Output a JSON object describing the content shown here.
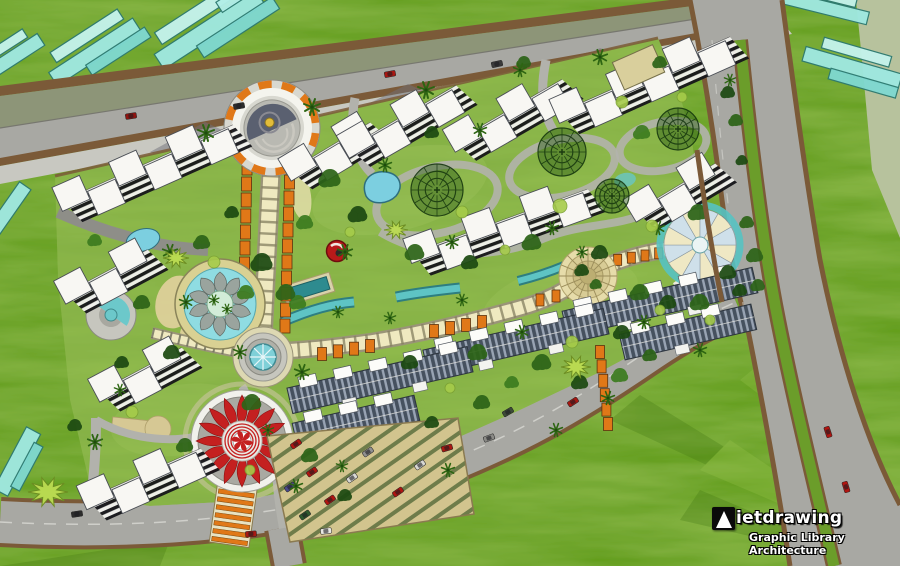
{
  "watermark": {
    "brand": "Vietdrawing",
    "brand_text_after_logo": "ietdrawing",
    "subtitle": "Graphic Library Architecture"
  },
  "palette": {
    "grass": "#639e1c",
    "site_lawn": "#84b044",
    "sage": "#b7c29d",
    "road_gray": "#a8a8a3",
    "road_olive": "#8d9578",
    "road_edge_brown": "#7b5a38",
    "sidewalk": "#c8c8c1",
    "water_cyan": "#8fdce2",
    "water_teal": "#5ec4c4",
    "glass_teal": "#9fe8e0",
    "building_white": "#f8f7f3",
    "roof_slate": "#46515f",
    "pergola_orange": "#e07818",
    "walkway_cream": "#efe9c0",
    "plaza_tan": "#e6dcaa",
    "flame_red": "#c42020",
    "sand": "#d2c48e",
    "tree_dark": "#1d4a12",
    "hedge_light": "#bcdc52"
  },
  "scene": {
    "glass_clusters": [
      {
        "x": 210,
        "y": 30,
        "ang": -33,
        "bars": [
          [
            -60,
            -10,
            120,
            18,
            "#9fe8e0"
          ],
          [
            -48,
            -28,
            100,
            14,
            "#c4f2ec"
          ],
          [
            -20,
            6,
            90,
            14,
            "#7fd8d0"
          ],
          [
            20,
            -20,
            60,
            12,
            "#b2eee8"
          ]
        ]
      },
      {
        "x": 95,
        "y": 52,
        "ang": -33,
        "bars": [
          [
            -50,
            -8,
            100,
            16,
            "#9fe8e0"
          ],
          [
            -38,
            -24,
            80,
            12,
            "#c4f2ec"
          ],
          [
            -15,
            6,
            70,
            12,
            "#7fd8d0"
          ]
        ]
      },
      {
        "x": 8,
        "y": 62,
        "ang": -33,
        "bars": [
          [
            -40,
            -8,
            80,
            14,
            "#9fe8e0"
          ],
          [
            -30,
            -20,
            60,
            10,
            "#c4f2ec"
          ]
        ]
      },
      {
        "x": 6,
        "y": 215,
        "ang": -55,
        "bars": [
          [
            -35,
            -8,
            70,
            14,
            "#9fe8e0"
          ]
        ]
      },
      {
        "x": 18,
        "y": 462,
        "ang": -62,
        "bars": [
          [
            -35,
            -9,
            70,
            16,
            "#9fe8e0"
          ],
          [
            -25,
            5,
            50,
            10,
            "#7fd8d0"
          ]
        ]
      },
      {
        "x": 824,
        "y": 8,
        "ang": 14,
        "bars": [
          [
            -45,
            -7,
            90,
            13,
            "#9fe8e0"
          ],
          [
            -30,
            -18,
            60,
            10,
            "#c4f2ec"
          ]
        ]
      },
      {
        "x": 852,
        "y": 68,
        "ang": 16,
        "bars": [
          [
            -50,
            -8,
            100,
            15,
            "#9fe8e0"
          ],
          [
            -35,
            -22,
            70,
            11,
            "#c4f2ec"
          ],
          [
            -20,
            6,
            70,
            11,
            "#7fd8d0"
          ]
        ]
      }
    ],
    "white_clusters": [
      {
        "x": 145,
        "y": 168,
        "ang": -24,
        "n": 6
      },
      {
        "x": 328,
        "y": 152,
        "ang": -31,
        "n": 3
      },
      {
        "x": 400,
        "y": 122,
        "ang": -30,
        "n": 4
      },
      {
        "x": 506,
        "y": 116,
        "ang": -30,
        "n": 4
      },
      {
        "x": 642,
        "y": 80,
        "ang": -24,
        "n": 6,
        "tan": true
      },
      {
        "x": 497,
        "y": 226,
        "ang": -20,
        "n": 6
      },
      {
        "x": 104,
        "y": 277,
        "ang": -28,
        "n": 3
      },
      {
        "x": 138,
        "y": 375,
        "ang": -28,
        "n": 3
      },
      {
        "x": 141,
        "y": 479,
        "ang": -24,
        "n": 4
      },
      {
        "x": 673,
        "y": 193,
        "ang": -31,
        "n": 3
      }
    ],
    "townhouse_rows": [
      {
        "x": 660,
        "y": 302,
        "len": 195,
        "ang": -13
      },
      {
        "x": 688,
        "y": 332,
        "len": 135,
        "ang": -13
      },
      {
        "x": 516,
        "y": 342,
        "len": 185,
        "ang": -13
      },
      {
        "x": 380,
        "y": 380,
        "len": 185,
        "ang": -13
      },
      {
        "x": 356,
        "y": 422,
        "len": 125,
        "ang": -13
      }
    ],
    "pergola_strips": [
      {
        "x1": 247,
        "y1": 168,
        "x2": 243,
        "y2": 328,
        "n": 11,
        "w": 10,
        "h": 14
      },
      {
        "x1": 290,
        "y1": 166,
        "x2": 285,
        "y2": 326,
        "n": 11,
        "w": 10,
        "h": 14
      },
      {
        "x1": 322,
        "y1": 354,
        "x2": 370,
        "y2": 346,
        "n": 4,
        "w": 9,
        "h": 13
      },
      {
        "x1": 434,
        "y1": 331,
        "x2": 482,
        "y2": 322,
        "n": 4,
        "w": 9,
        "h": 13
      },
      {
        "x1": 600,
        "y1": 352,
        "x2": 608,
        "y2": 424,
        "n": 6,
        "w": 9,
        "h": 13
      },
      {
        "x1": 604,
        "y1": 262,
        "x2": 686,
        "y2": 249,
        "n": 7,
        "w": 8,
        "h": 11
      },
      {
        "x1": 540,
        "y1": 300,
        "x2": 572,
        "y2": 292,
        "n": 3,
        "w": 8,
        "h": 12
      }
    ],
    "tree_rings": [
      [
        437,
        190,
        26
      ],
      [
        562,
        152,
        24
      ],
      [
        678,
        129,
        21
      ],
      [
        612,
        196,
        17
      ]
    ],
    "trees": [
      [
        330,
        178,
        9,
        1
      ],
      [
        358,
        214,
        8,
        0
      ],
      [
        305,
        222,
        7,
        2
      ],
      [
        415,
        252,
        8,
        1
      ],
      [
        470,
        262,
        7,
        0
      ],
      [
        532,
        242,
        8,
        1
      ],
      [
        600,
        252,
        7,
        0
      ],
      [
        640,
        292,
        8,
        1
      ],
      [
        668,
        302,
        7,
        0
      ],
      [
        700,
        302,
        8,
        1
      ],
      [
        622,
        332,
        7,
        0
      ],
      [
        478,
        352,
        8,
        1
      ],
      [
        410,
        362,
        7,
        0
      ],
      [
        252,
        402,
        8,
        1
      ],
      [
        172,
        352,
        7,
        0
      ],
      [
        142,
        302,
        7,
        1
      ],
      [
        122,
        362,
        6,
        0
      ],
      [
        202,
        242,
        7,
        1
      ],
      [
        232,
        212,
        6,
        0
      ],
      [
        542,
        362,
        8,
        1
      ],
      [
        580,
        382,
        7,
        0
      ],
      [
        298,
        302,
        7,
        2
      ],
      [
        698,
        212,
        8,
        1
      ],
      [
        728,
        272,
        7,
        0
      ],
      [
        642,
        132,
        7,
        2
      ],
      [
        524,
        62,
        6,
        1
      ],
      [
        432,
        132,
        6,
        0
      ],
      [
        482,
        402,
        7,
        1
      ],
      [
        432,
        422,
        6,
        0
      ],
      [
        512,
        382,
        6,
        2
      ],
      [
        660,
        62,
        6,
        1
      ],
      [
        728,
        92,
        6,
        0
      ],
      [
        755,
        255,
        7,
        1
      ],
      [
        740,
        290,
        6,
        0
      ],
      [
        95,
        240,
        6,
        2
      ],
      [
        185,
        445,
        7,
        1
      ],
      [
        75,
        425,
        6,
        0
      ],
      [
        310,
        455,
        7,
        1
      ],
      [
        345,
        495,
        6,
        0
      ],
      [
        620,
        375,
        7,
        2
      ],
      [
        650,
        355,
        6,
        1
      ],
      [
        262,
        262,
        9,
        0
      ],
      [
        286,
        292,
        8,
        1
      ],
      [
        246,
        292,
        7,
        2
      ],
      [
        736,
        120,
        6,
        1
      ],
      [
        742,
        160,
        5,
        0
      ],
      [
        747,
        222,
        6,
        1
      ],
      [
        758,
        285,
        6,
        1
      ],
      [
        582,
        270,
        6,
        0
      ],
      [
        596,
        284,
        5,
        1
      ]
    ],
    "palms": [
      [
        206,
        133,
        1
      ],
      [
        312,
        107,
        1
      ],
      [
        426,
        90,
        1
      ],
      [
        600,
        57,
        0.9
      ],
      [
        520,
        70,
        0.8
      ],
      [
        170,
        252,
        0.9
      ],
      [
        345,
        252,
        0.9
      ],
      [
        452,
        242,
        0.8
      ],
      [
        302,
        372,
        0.9
      ],
      [
        522,
        332,
        0.8
      ],
      [
        644,
        322,
        0.8
      ],
      [
        95,
        442,
        0.9
      ],
      [
        480,
        130,
        0.8
      ],
      [
        552,
        228,
        0.8
      ],
      [
        385,
        165,
        0.8
      ],
      [
        240,
        352,
        0.8
      ],
      [
        268,
        430,
        0.7
      ],
      [
        700,
        350,
        0.8
      ],
      [
        448,
        470,
        0.8
      ],
      [
        556,
        430,
        0.8
      ],
      [
        608,
        398,
        0.8
      ],
      [
        658,
        228,
        0.8
      ],
      [
        186,
        302,
        0.8
      ],
      [
        120,
        390,
        0.7
      ],
      [
        338,
        312,
        0.7
      ],
      [
        390,
        318,
        0.7
      ],
      [
        462,
        300,
        0.7
      ],
      [
        582,
        252,
        0.7
      ],
      [
        296,
        486,
        0.8
      ],
      [
        342,
        466,
        0.7
      ],
      [
        730,
        80,
        0.7
      ],
      [
        214,
        300,
        0.62
      ],
      [
        227,
        309,
        0.6
      ]
    ],
    "bushes": [
      [
        214,
        262,
        6
      ],
      [
        560,
        206,
        7
      ],
      [
        462,
        212,
        6
      ],
      [
        652,
        226,
        6
      ],
      [
        132,
        412,
        6
      ],
      [
        622,
        102,
        6
      ],
      [
        682,
        97,
        5
      ],
      [
        350,
        232,
        5
      ],
      [
        505,
        250,
        5
      ],
      [
        572,
        342,
        6
      ],
      [
        450,
        388,
        5
      ],
      [
        250,
        470,
        5
      ],
      [
        660,
        310,
        5
      ],
      [
        710,
        320,
        5
      ]
    ],
    "hedges": [
      [
        48,
        492,
        20
      ],
      [
        576,
        367,
        15
      ],
      [
        176,
        258,
        13
      ],
      [
        396,
        230,
        12
      ]
    ],
    "road_cars": [
      {
        "x": 131,
        "y": 116,
        "a": -9,
        "c": "#8e1410"
      },
      {
        "x": 239,
        "y": 106,
        "a": -10,
        "c": "#2c2c2c"
      },
      {
        "x": 390,
        "y": 74,
        "a": -11,
        "c": "#a81812"
      },
      {
        "x": 497,
        "y": 64,
        "a": -12,
        "c": "#3a3a3a"
      },
      {
        "x": 447,
        "y": 448,
        "a": -17,
        "c": "#a81812"
      },
      {
        "x": 489,
        "y": 438,
        "a": -20,
        "c": "#8a8a86"
      },
      {
        "x": 508,
        "y": 412,
        "a": -31,
        "c": "#3d4a38"
      },
      {
        "x": 573,
        "y": 402,
        "a": -33,
        "c": "#a81812"
      },
      {
        "x": 251,
        "y": 534,
        "a": -4,
        "c": "#a81812"
      },
      {
        "x": 326,
        "y": 531,
        "a": -7,
        "c": "#e8e8e4"
      },
      {
        "x": 77,
        "y": 514,
        "a": -8,
        "c": "#2c2c2c"
      },
      {
        "x": 828,
        "y": 432,
        "a": 72,
        "c": "#b01510"
      },
      {
        "x": 846,
        "y": 487,
        "a": 73,
        "c": "#b01510"
      }
    ],
    "parking_cars": [
      {
        "x": 296,
        "y": 444,
        "a": -35,
        "c": "#b01510"
      },
      {
        "x": 312,
        "y": 472,
        "a": -35,
        "c": "#b01510"
      },
      {
        "x": 330,
        "y": 500,
        "a": -35,
        "c": "#b01510"
      },
      {
        "x": 352,
        "y": 478,
        "a": -35,
        "c": "#d8d8d4"
      },
      {
        "x": 368,
        "y": 452,
        "a": -35,
        "c": "#909090"
      },
      {
        "x": 305,
        "y": 515,
        "a": -35,
        "c": "#2d5a2d"
      },
      {
        "x": 398,
        "y": 492,
        "a": -35,
        "c": "#b01510"
      },
      {
        "x": 420,
        "y": 465,
        "a": -35,
        "c": "#d8d8d4"
      },
      {
        "x": 290,
        "y": 487,
        "a": -35,
        "c": "#4a4a8a"
      }
    ]
  }
}
